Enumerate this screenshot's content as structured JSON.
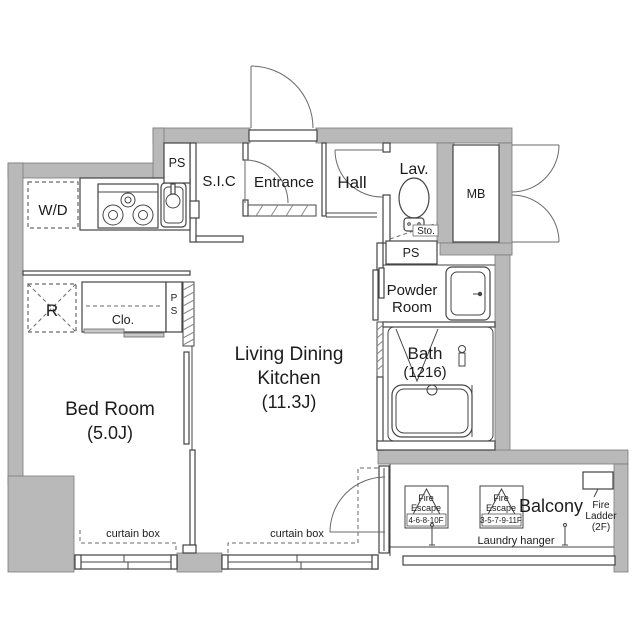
{
  "plan": {
    "rooms": {
      "sic": "S.I.C",
      "entrance": "Entrance",
      "hall": "Hall",
      "lav": "Lav.",
      "powder_line1": "Powder",
      "powder_line2": "Room",
      "bath_line1": "Bath",
      "bath_line2": "(1216)",
      "ldk_line1": "Living Dining",
      "ldk_line2": "Kitchen",
      "ldk_line3": "(11.3J)",
      "bedroom_line1": "Bed Room",
      "bedroom_line2": "(5.0J)",
      "balcony": "Balcony"
    },
    "labels": {
      "ps_top": "PS",
      "ps_mid": "PS",
      "ps_bed_p": "P",
      "ps_bed_s": "S",
      "mb": "MB",
      "sto": "Sto.",
      "wd": "W/D",
      "refrigerator": "R",
      "closet": "Clo.",
      "curtain_box_bedroom": "curtain box",
      "curtain_box_ldk": "curtain box",
      "laundry_hanger": "Laundry hanger"
    },
    "balcony_items": {
      "fe1_line1": "Fire",
      "fe1_line2": "Escape",
      "fe1_line3": "4-6-8-10F",
      "fe2_line1": "Fire",
      "fe2_line2": "Escape",
      "fe2_line3": "3-5-7-9-11F",
      "ladder_line1": "Fire",
      "ladder_line2": "Ladder",
      "ladder_line3": "(2F)"
    },
    "colors": {
      "wall": "#b9b9b9",
      "line": "#444444",
      "text": "#1c1c1c",
      "background": "#ffffff"
    }
  }
}
